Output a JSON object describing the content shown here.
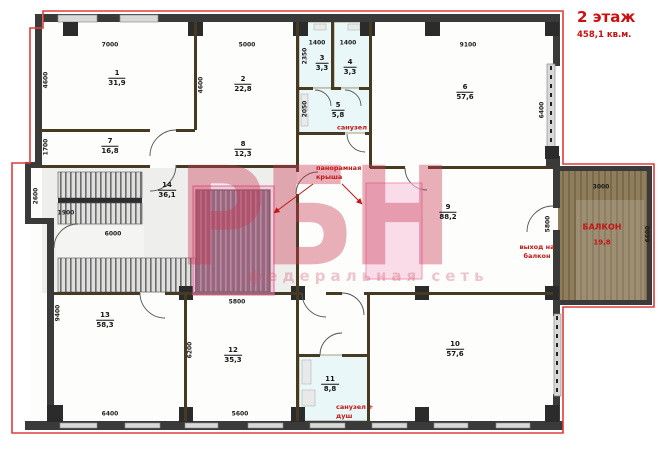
{
  "title": {
    "floor": "2 этаж",
    "total_area": "458,1 кв.м."
  },
  "watermark": {
    "logo": "РБН",
    "subtitle": "федеральная сеть"
  },
  "rooms": [
    {
      "number": "1",
      "area": "31,9"
    },
    {
      "number": "2",
      "area": "22,8"
    },
    {
      "number": "3",
      "area": "3,3"
    },
    {
      "number": "4",
      "area": "3,3"
    },
    {
      "number": "5",
      "area": "5,8"
    },
    {
      "number": "6",
      "area": "57,6"
    },
    {
      "number": "7",
      "area": "16,8"
    },
    {
      "number": "8",
      "area": "12,3"
    },
    {
      "number": "9",
      "area": "88,2"
    },
    {
      "number": "10",
      "area": "57,6"
    },
    {
      "number": "11",
      "area": "8,8"
    },
    {
      "number": "12",
      "area": "35,3"
    },
    {
      "number": "13",
      "area": "58,3"
    },
    {
      "number": "14",
      "area": "36,1"
    }
  ],
  "balcony": {
    "name": "БАЛКОН",
    "area": "19,8"
  },
  "annotations": {
    "panoramic_roof_line1": "панорамная",
    "panoramic_roof_line2": "крыша",
    "bathroom": "санузел",
    "bathroom_shower_line1": "санузел +",
    "bathroom_shower_line2": "душ",
    "balcony_exit_line1": "выход на",
    "balcony_exit_line2": "балкон"
  },
  "dimensions": {
    "room1_top": "7000",
    "room2_top": "5000",
    "room3_top": "1400",
    "room4_top": "1400",
    "room6_top": "9100",
    "room1_left": "4600",
    "room7_left": "1700",
    "niche_left": "2600",
    "niche_bottom": "1900",
    "room13_left": "9400",
    "room2_left": "4600",
    "room3_side": "2350",
    "room5_side": "2050",
    "room6_right": "6400",
    "stairs_bottom": "6000",
    "room12_top": "5800",
    "room12_left": "6200",
    "room13_bottom": "6400",
    "room12_bottom": "5600",
    "room9_right": "5800",
    "balcony_top": "3000",
    "balcony_right": "6600"
  },
  "colors": {
    "accent_red": "#cc0f0f",
    "boundary_red": "#e23b3b",
    "wall": "#3a3a3a",
    "bathroom_fill": "#eaf7f8",
    "balcony_wood": "#8f7d5c",
    "highlight_pink": "#f5a0c3",
    "watermark_pink": "#cb3a54"
  }
}
